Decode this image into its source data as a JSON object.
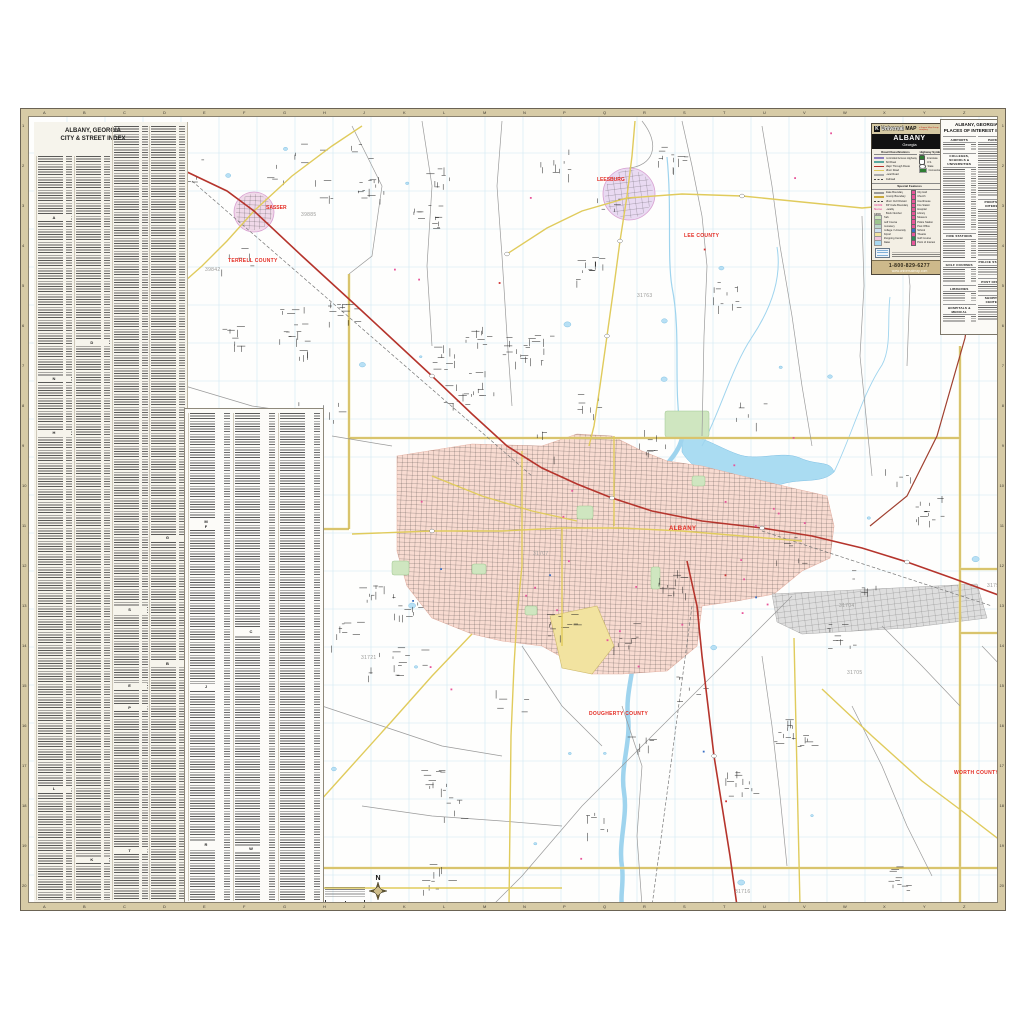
{
  "street_index": {
    "title1": "ALBANY, GEORGIA",
    "title2": "CITY & STREET INDEX",
    "section_letters": "ABCDEFGHJKLMNPRSTW",
    "panel1_columns": 4,
    "panel2_columns": 3
  },
  "poi_index": {
    "title1": "ALBANY, GEORGIA",
    "title2": "PLACES OF INTEREST INDEX",
    "left_sections": [
      {
        "name": "AIRPORTS",
        "rows": 3
      },
      {
        "name": "COLLEGES, SCHOOLS & UNIVERSITIES",
        "rows": 27
      },
      {
        "name": "FIRE STATIONS",
        "rows": 8
      },
      {
        "name": "GOLF COURSES",
        "rows": 6
      },
      {
        "name": "LIBRARIES",
        "rows": 4
      },
      {
        "name": "HOSPITALS & MEDICAL",
        "rows": 3
      }
    ],
    "right_sections": [
      {
        "name": "PARKS",
        "rows": 23
      },
      {
        "name": "POINTS OF INTEREST",
        "rows": 20
      },
      {
        "name": "POLICE STATIONS",
        "rows": 4
      },
      {
        "name": "POST OFFICES",
        "rows": 3
      },
      {
        "name": "SHOPPING CENTERS",
        "rows": 6
      }
    ]
  },
  "legend": {
    "brand_k": "K",
    "brand": "Universal",
    "brand_bold": "MAP",
    "brand_tag": "a Kappa Map Group company",
    "title": "ALBANY",
    "subtitle": "Georgia",
    "road_header": "Road Classifications",
    "hwy_header": "Highway Symbols",
    "special_header": "Special Features",
    "road_classes": [
      {
        "label": "Controlled Access Highway",
        "color": "#8f7fc0"
      },
      {
        "label": "Toll Road",
        "color": "#58a8a0"
      },
      {
        "label": "Major Through Route",
        "color": "#b5342c"
      },
      {
        "label": "Minor Road",
        "color": "#e0cb5c"
      },
      {
        "label": "Local Road",
        "color": "#ababab"
      },
      {
        "label": "Railroad",
        "color": "#555555"
      }
    ],
    "hwy_symbols": [
      {
        "label": "Interstate",
        "glyph": "shield",
        "color": "#2e7d32"
      },
      {
        "label": "U.S.",
        "glyph": "shield",
        "color": "#ffffff"
      },
      {
        "label": "State",
        "glyph": "oval",
        "color": "#ffffff"
      },
      {
        "label": "Connector",
        "glyph": "box",
        "color": "#2e7d32"
      }
    ],
    "special_left": [
      {
        "label": "State Boundary",
        "sw": "line",
        "color": "#9a9a9a"
      },
      {
        "label": "County Boundary",
        "sw": "line",
        "color": "#c8a83c"
      },
      {
        "label": "Minor Civil Division",
        "sw": "rail",
        "color": "#bbbbbb"
      },
      {
        "label": "ZIP Code Boundary",
        "sw": "txt",
        "color": "#e868a8",
        "sample": "31699"
      },
      {
        "label": "Locality",
        "sw": "txt",
        "color": "#e868a8",
        "sample": "Name"
      },
      {
        "label": "Block Number",
        "sw": "txt",
        "color": "#444444",
        "sample": "1200"
      },
      {
        "label": "Park",
        "sw": "box",
        "color": "#cfe6c0"
      },
      {
        "label": "Golf Course",
        "sw": "box",
        "color": "#9cc48e"
      },
      {
        "label": "Cemetery",
        "sw": "box",
        "color": "#bcd8cc"
      },
      {
        "label": "College / University",
        "sw": "box",
        "color": "#cfe0f0"
      },
      {
        "label": "Airport",
        "sw": "box",
        "color": "#f2e3a0"
      },
      {
        "label": "Shopping Center",
        "sw": "box",
        "color": "#f3c7de"
      },
      {
        "label": "Water",
        "sw": "box",
        "color": "#a9d9f1"
      }
    ],
    "special_right": [
      {
        "label": "City Hall",
        "color": "#e8559a"
      },
      {
        "label": "Church",
        "color": "#e8559a"
      },
      {
        "label": "Courthouse",
        "color": "#e8559a"
      },
      {
        "label": "Fire Station",
        "color": "#e8559a"
      },
      {
        "label": "Hospital",
        "color": "#e8559a"
      },
      {
        "label": "Library",
        "color": "#e8559a"
      },
      {
        "label": "Museum",
        "color": "#e8559a"
      },
      {
        "label": "Police Station",
        "color": "#e8559a"
      },
      {
        "label": "Post Office",
        "color": "#e8559a"
      },
      {
        "label": "School",
        "color": "#3a6fc4"
      },
      {
        "label": "Theatre",
        "color": "#e8559a"
      },
      {
        "label": "Golf Course",
        "color": "#2e8b57"
      },
      {
        "label": "Point of Interest",
        "color": "#e8559a"
      }
    ],
    "footer_phone": "1-800-829-6277",
    "footer_web": "www.universalmap.com"
  },
  "map": {
    "compass_label": "N",
    "copyright": "Copyright © Universal Map",
    "labels": [
      {
        "text": "SASSER",
        "x": 237,
        "y": 88,
        "type": "town"
      },
      {
        "text": "39885",
        "x": 272,
        "y": 95,
        "type": "zip"
      },
      {
        "text": "TERRELL COUNTY",
        "x": 199,
        "y": 141,
        "type": "county"
      },
      {
        "text": "39842",
        "x": 176,
        "y": 150,
        "type": "zip"
      },
      {
        "text": "LEESBURG",
        "x": 568,
        "y": 60,
        "type": "town"
      },
      {
        "text": "LEE COUNTY",
        "x": 655,
        "y": 116,
        "type": "county"
      },
      {
        "text": "31763",
        "x": 608,
        "y": 176,
        "type": "zip"
      },
      {
        "text": "31707",
        "x": 504,
        "y": 434,
        "type": "zip"
      },
      {
        "text": "ALBANY",
        "x": 640,
        "y": 409,
        "type": "city"
      },
      {
        "text": "31721",
        "x": 332,
        "y": 538,
        "type": "zip"
      },
      {
        "text": "31704",
        "x": 810,
        "y": 486,
        "type": "zip"
      },
      {
        "text": "31705",
        "x": 818,
        "y": 553,
        "type": "zip"
      },
      {
        "text": "31791",
        "x": 958,
        "y": 466,
        "type": "zip"
      },
      {
        "text": "WORTH COUNTY",
        "x": 925,
        "y": 653,
        "type": "county"
      },
      {
        "text": "DOUGHERTY COUNTY",
        "x": 560,
        "y": 594,
        "type": "county"
      },
      {
        "text": "31716",
        "x": 706,
        "y": 772,
        "type": "zip"
      },
      {
        "text": "MITCHELL COUNTY",
        "x": 742,
        "y": 789,
        "type": "county"
      }
    ]
  },
  "frame": {
    "grid_letters": "ABCDEFGHJKLMNPQRSTUVWXYZ",
    "grid_numbers": "1,2,3,4,5,6,7,8,9,10,11,12,13,14,15,16,17,18,19,20"
  },
  "colors": {
    "label_red": "#e42c23",
    "county_boundary": "#c8a83c",
    "city_fill": "#f8dbd1",
    "water": "#a9d9f1",
    "highway_red": "#b5342c",
    "road_yellow": "#e0cb5c",
    "frame_tan": "#d7cba6"
  }
}
